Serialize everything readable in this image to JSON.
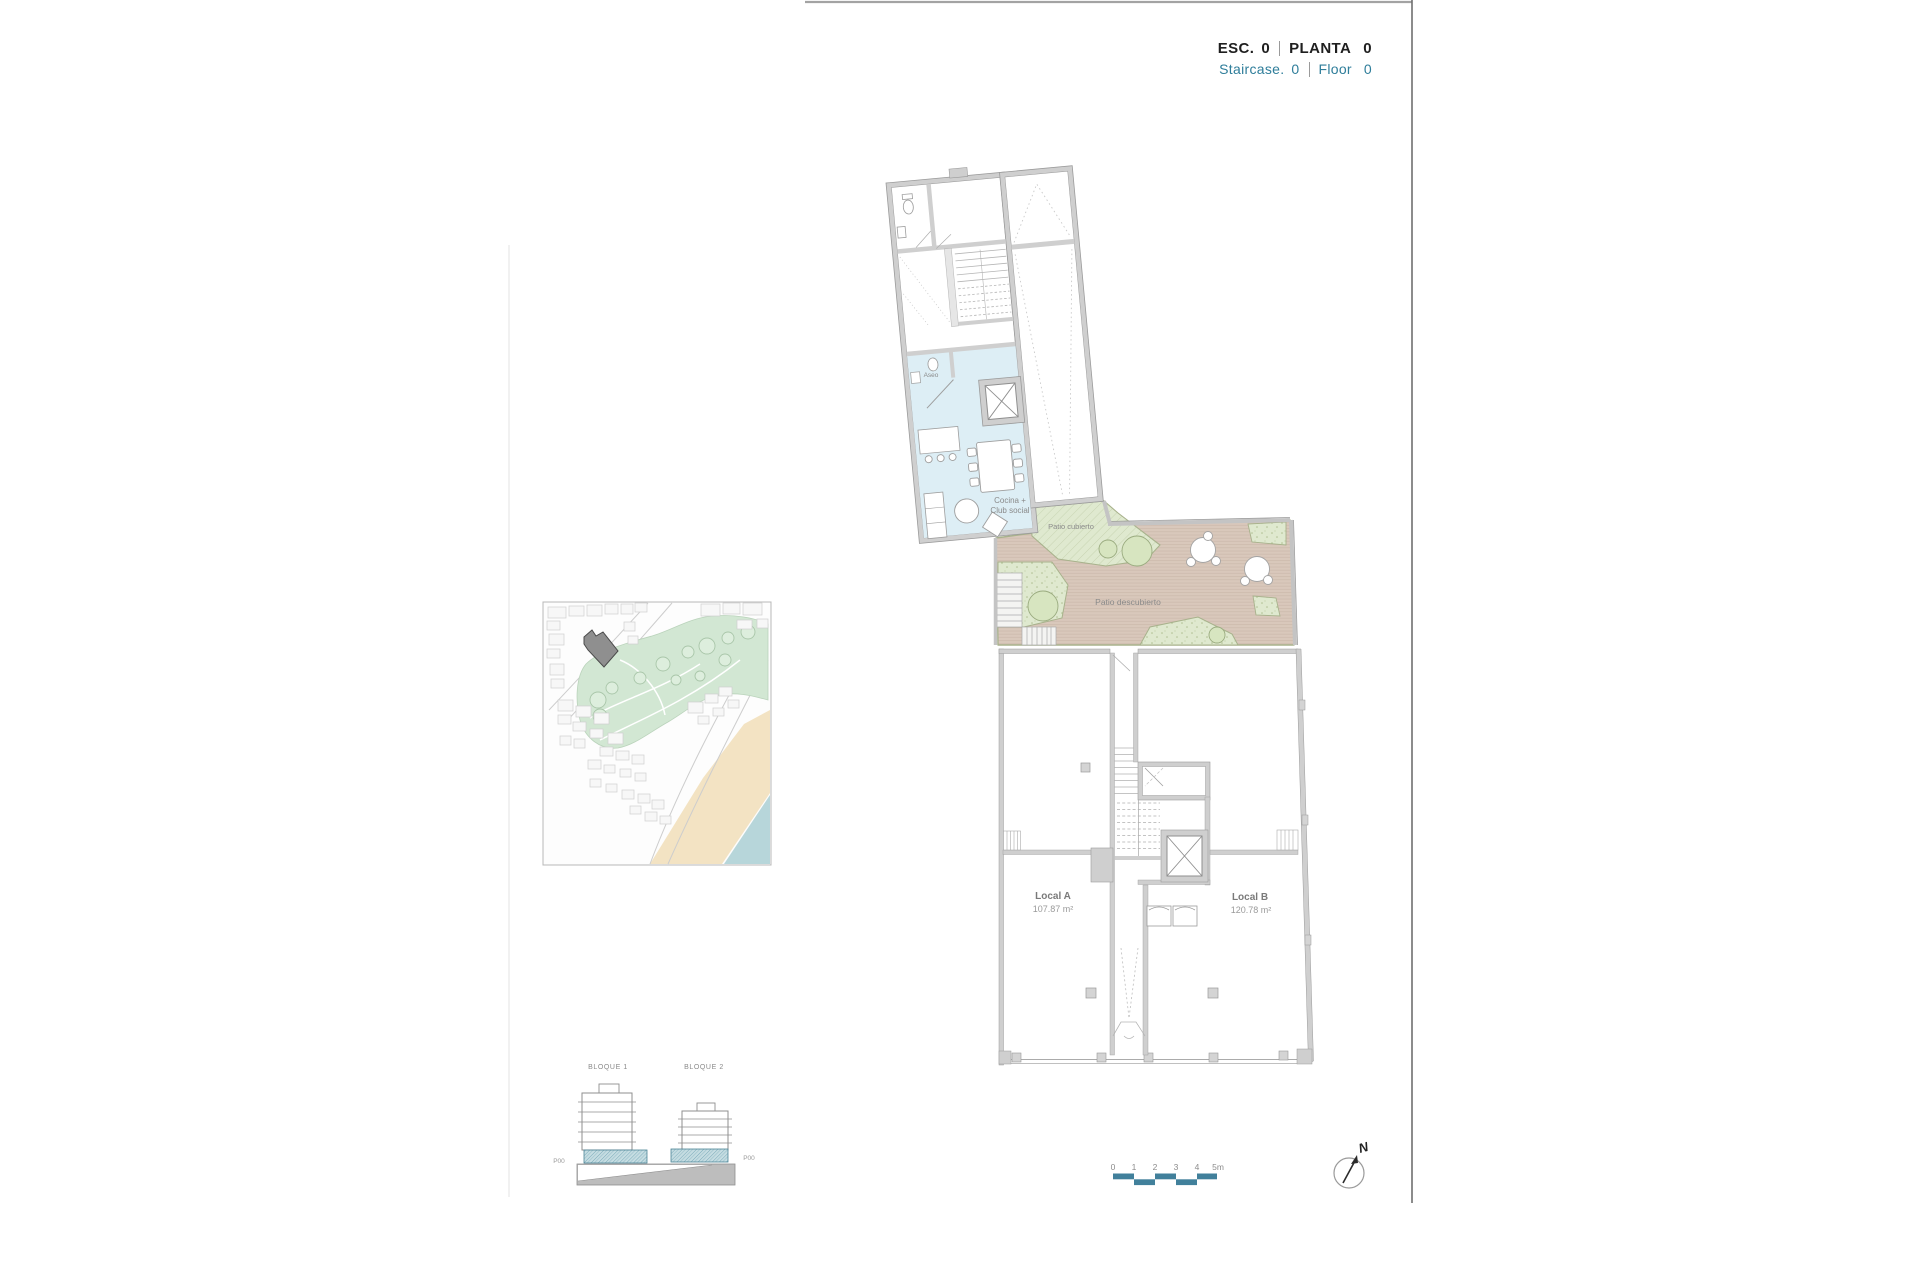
{
  "header": {
    "esc_label": "ESC.",
    "esc_value": "0",
    "planta_label": "PLANTA",
    "planta_value": "0",
    "staircase_label": "Staircase.",
    "staircase_value": "0",
    "floor_label": "Floor",
    "floor_value": "0"
  },
  "plan": {
    "aseo": "Aseo",
    "cocina_line1": "Cocina +",
    "cocina_line2": "Club social",
    "patio_cubierto": "Patio cubierto",
    "patio_descubierto": "Patio descubierto",
    "local_a_name": "Local A",
    "local_a_area": "107.87 m²",
    "local_b_name": "Local B",
    "local_b_area": "120.78 m²"
  },
  "elevation": {
    "block1": "BLOQUE 1",
    "block2": "BLOQUE 2",
    "p00_left": "P00",
    "p00_right": "P00"
  },
  "scale_bar": {
    "ticks": [
      "0",
      "1",
      "2",
      "3",
      "4",
      "5m"
    ]
  },
  "compass": {
    "north_label": "N"
  },
  "colors": {
    "accent_teal": "#2e7d9a",
    "scalebar_teal": "#41809b",
    "wall_gray": "#cfcfcf",
    "club_social_blue": "#ddeef5",
    "patio_green": "#dfe9cf",
    "deck_tan": "#d9c8bb",
    "map_park_green": "#d2e7d3",
    "map_beach_sand": "#f3e3c3",
    "map_sea_blue": "#b7d6da",
    "plot_dark_gray": "#8f8f8f"
  }
}
